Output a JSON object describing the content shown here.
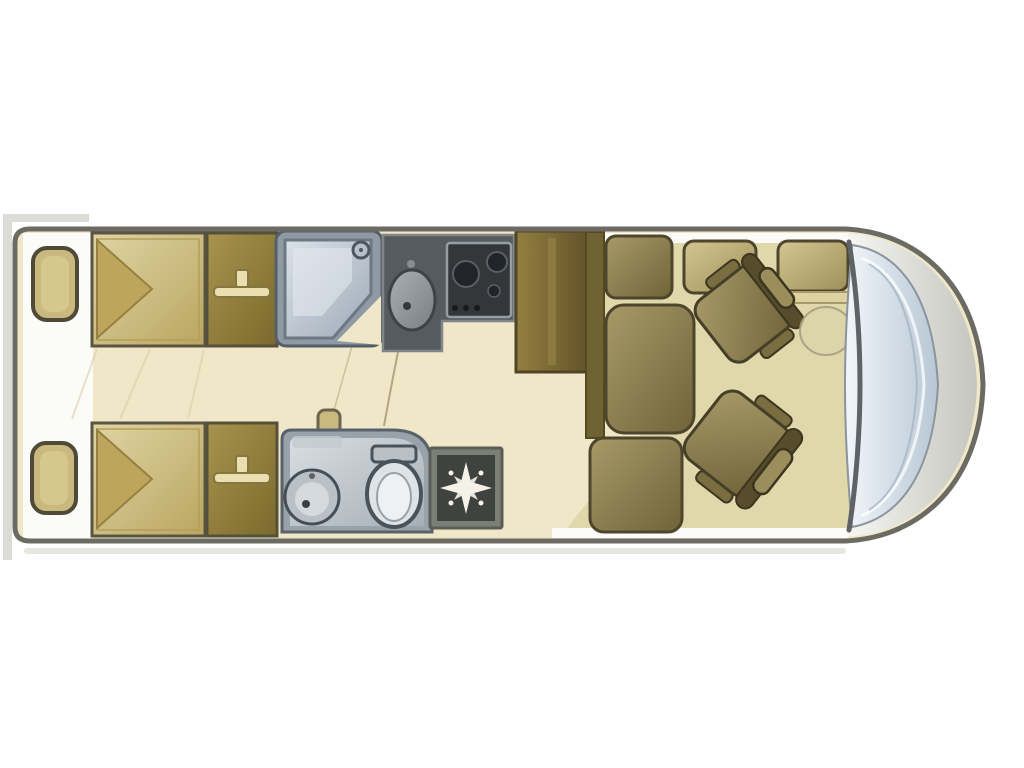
{
  "meta": {
    "description": "Motorhome (A-class RV) floor plan, plan view, rear at left and cab with wrap-around windscreen at right",
    "diagram_type": "floorplan"
  },
  "zones": [
    "Rear twin single beds with rear lockers",
    "His-and-hers wardrobes with hanging rails",
    "Shower cubicle (top side)",
    "Washroom with washbasin and toilet (bottom side)",
    "Kitchen unit with round sink and hob",
    "Tall fridge / storage tower",
    "Lounge with side seats and dinette benches",
    "Heater / vent unit",
    "Two swivel cab seats and lounge table",
    "Wrap-around windscreen at the front"
  ],
  "colors": {
    "page_bg": "#ffffff",
    "photo_border": "#dcdcd6",
    "body_outline": "#6b6a63",
    "floor": "#efe7c8",
    "floor_lounge": "#e0d8ab",
    "wall_white": "#fbfbf8",
    "bed": "#d8c88f",
    "pillow": "#bda65c",
    "wardrobe": "#998540",
    "hanger": "#eadfae",
    "shower_frame": "#8f9aa5",
    "shower_glass": "#c9d2dc",
    "kitchen_unit": "#565b5f",
    "cooktop": "#33373a",
    "burner": "#212428",
    "cabinet": "#84703a",
    "seat": "#9c8e5c",
    "seat_dark": "#6f6334",
    "seat_stroke": "#4d452c",
    "bench": "#cabb85",
    "bath_shell": "#99a2ab",
    "porcelain": "#dde3e7",
    "heater_frame": "#7c7f76",
    "heater_face": "#3f423f",
    "star": "#f5f2ea",
    "glass": "#cfdbe6",
    "glass_stroke": "#8b949c",
    "nose": "#d9d9d2",
    "dash": "#5f6366",
    "shadow": "#e7e7e2",
    "accent_tan": "#c9b97f",
    "table": "#dcd5a9",
    "floor_line": "#d9cfa7"
  },
  "items": {
    "floorplan": "Motorhome floor plan",
    "body": "Vehicle body outline",
    "nose": "Front nose of cab",
    "windshield": "Wrap-around windscreen",
    "dashboard": "Dashboard edge",
    "rear_shelf_top": "Rear locker (top)",
    "rear_shelf_bottom": "Rear locker (bottom)",
    "bed_top": "Single bed (top)",
    "bed_bottom": "Single bed (bottom)",
    "pillow_top": "Bed pillow / folded duvet (top)",
    "pillow_bottom": "Bed pillow / folded duvet (bottom)",
    "wardrobe_top": "Wardrobe with hanging rail (top)",
    "wardrobe_bottom": "Wardrobe with hanging rail (bottom)",
    "hanger_top": "Clothes hanger symbol",
    "hanger_bottom": "Clothes hanger symbol",
    "shower": "Shower cubicle",
    "shower_head": "Shower head",
    "kitchen": "Kitchen unit",
    "sink": "Round kitchen sink",
    "cooktop": "Gas hob with burners",
    "cabinet": "Fridge / tall cabinet",
    "seat_panel": "Seat side panel",
    "seat_back": "Lounge seat cushion (top)",
    "seat_long": "Lounge seat cushion (middle)",
    "seat_front": "Lounge seat cushion (bottom)",
    "bench_rear": "Dinette bench seat (left)",
    "bench_front": "Dinette bench seat (right)",
    "shelf_ledge": "Side shelf behind bench",
    "chair_passenger": "Swivel cab seat (top)",
    "chair_driver": "Swivel cab seat (bottom)",
    "table": "Lounge table",
    "washroom": "Washroom",
    "basin": "Washbasin",
    "toilet": "Toilet with cistern",
    "door_handle": "Washroom door handle",
    "door_swing": "Washroom door line",
    "heater": "Heater / vent unit with star symbol",
    "lounge_floor": "Lounge floor area",
    "aisle": "Bedroom aisle floor"
  }
}
